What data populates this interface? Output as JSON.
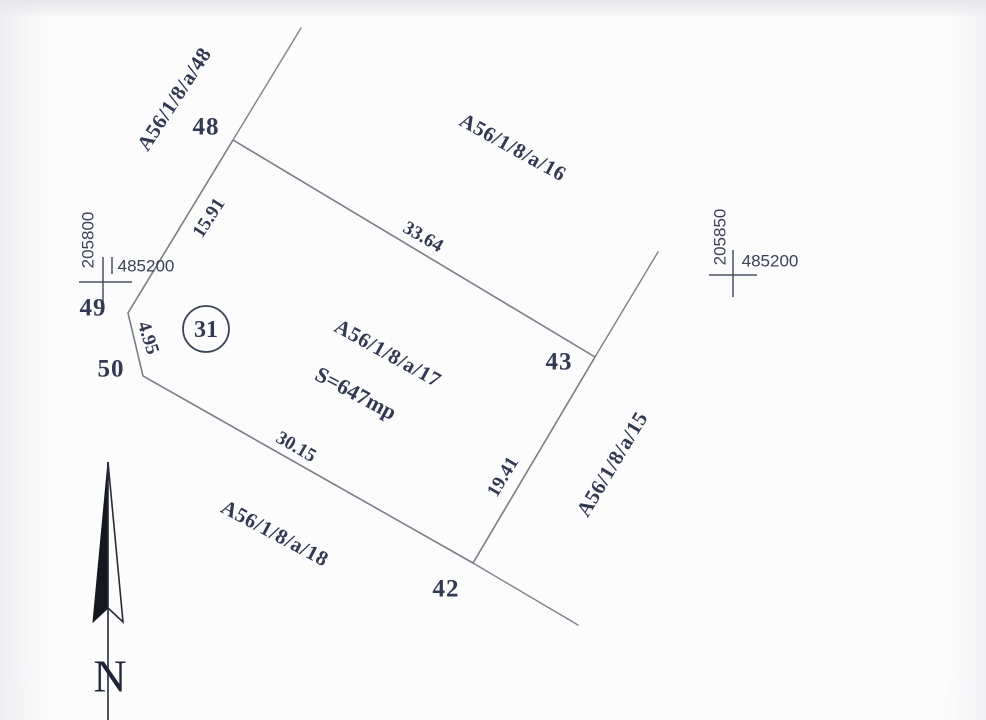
{
  "drawing_type": "cadastral parcel sketch",
  "colors": {
    "ink": "#313a52",
    "boundary_line": "#787d88",
    "paper": "#fbfbfd",
    "north_arrow_fill": "#15181f"
  },
  "parcels": {
    "p48": "A56/1/8/a/48",
    "p16": "A56/1/8/a/16",
    "p17": "A56/1/8/a/17",
    "p15": "A56/1/8/a/15",
    "p18": "A56/1/8/a/18"
  },
  "parcel17": {
    "area": "S=647mp",
    "circle_number": "31"
  },
  "points": {
    "p48": "48",
    "p49": "49",
    "p50": "50",
    "p42": "42",
    "p43": "43"
  },
  "dimensions": {
    "d48_49": "15.91",
    "d49_50": "4.95",
    "d50_42": "30.15",
    "d42_43": "19.41",
    "d43_48": "33.64"
  },
  "grid_crosses": {
    "left": {
      "northing": "205800",
      "easting": "485200"
    },
    "right": {
      "northing": "205850",
      "easting": "485200"
    }
  },
  "compass": {
    "north_label": "N"
  }
}
